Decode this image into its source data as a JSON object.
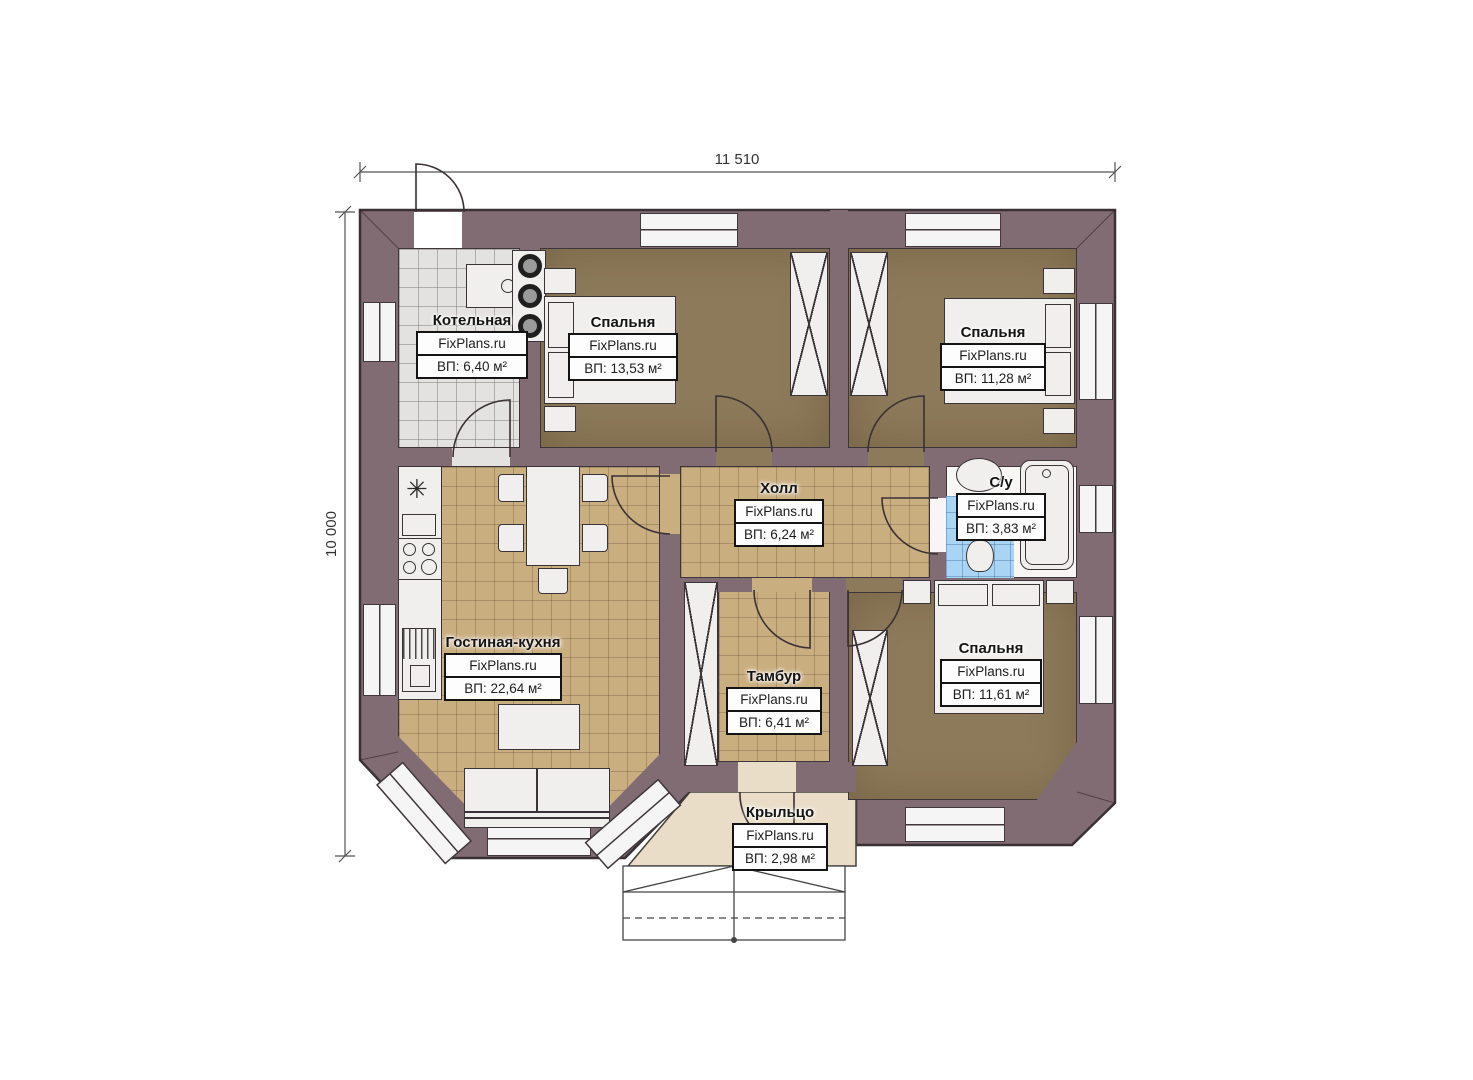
{
  "brand": "FixPlans.ru",
  "dimensions": {
    "top": "11 510",
    "left": "10 000"
  },
  "rooms": [
    {
      "name": "Котельная",
      "site": "FixPlans.ru",
      "area": "ВП: 6,40 м²"
    },
    {
      "name": "Спальня",
      "site": "FixPlans.ru",
      "area": "ВП: 13,53 м²"
    },
    {
      "name": "Спальня",
      "site": "FixPlans.ru",
      "area": "ВП: 11,28 м²"
    },
    {
      "name": "Холл",
      "site": "FixPlans.ru",
      "area": "ВП: 6,24 м²"
    },
    {
      "name": "С/у",
      "site": "FixPlans.ru",
      "area": "ВП: 3,83 м²"
    },
    {
      "name": "Гостиная-кухня",
      "site": "FixPlans.ru",
      "area": "ВП: 22,64 м²"
    },
    {
      "name": "Тамбур",
      "site": "FixPlans.ru",
      "area": "ВП: 6,41 м²"
    },
    {
      "name": "Спальня",
      "site": "FixPlans.ru",
      "area": "ВП: 11,61 м²"
    },
    {
      "name": "Крыльцо",
      "site": "FixPlans.ru",
      "area": "ВП: 2,98 м²"
    }
  ],
  "colors": {
    "wall": "#826c73",
    "bedroom_floor": "#8d7a5a",
    "tile_floor": "#c9ae80",
    "boiler_floor": "#e3e2e0",
    "bathroom_tile": "#a9d4f3",
    "porch_floor": "#e9ddc7"
  }
}
